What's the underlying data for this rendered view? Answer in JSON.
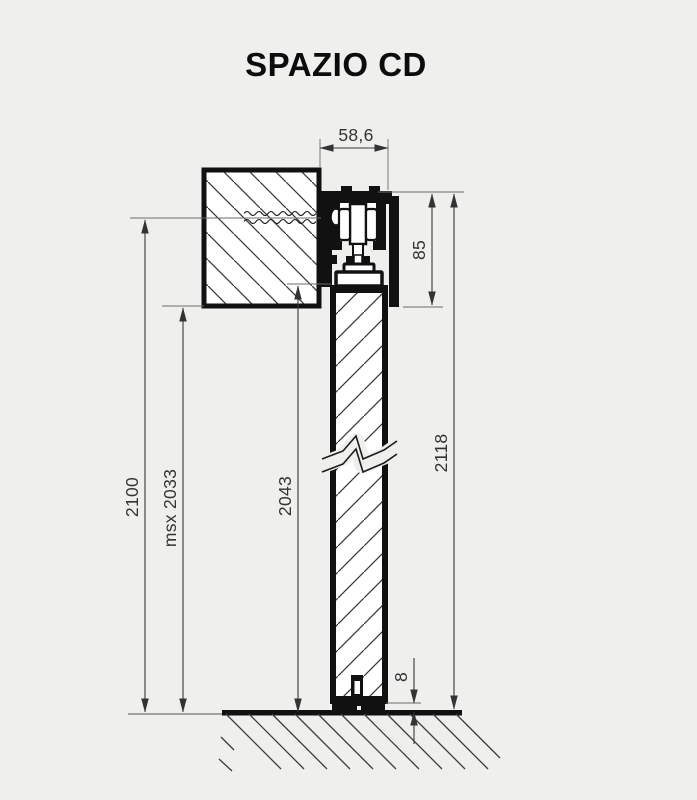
{
  "title": "SPAZIO CD",
  "colors": {
    "background": "#efefed",
    "drawing_line": "#111111",
    "dimension_line": "#3a3a3a",
    "hatch": "#3c3c3c",
    "text": "#333333"
  },
  "dimensions": {
    "track_width": {
      "label": "58,6"
    },
    "track_height": {
      "label": "85"
    },
    "overall_height": {
      "label": "2118"
    },
    "fixing_height": {
      "label": "2100"
    },
    "msx_height": {
      "label": "msx 2033"
    },
    "door_height": {
      "label": "2043"
    },
    "floor_gap": {
      "label": "8"
    }
  }
}
